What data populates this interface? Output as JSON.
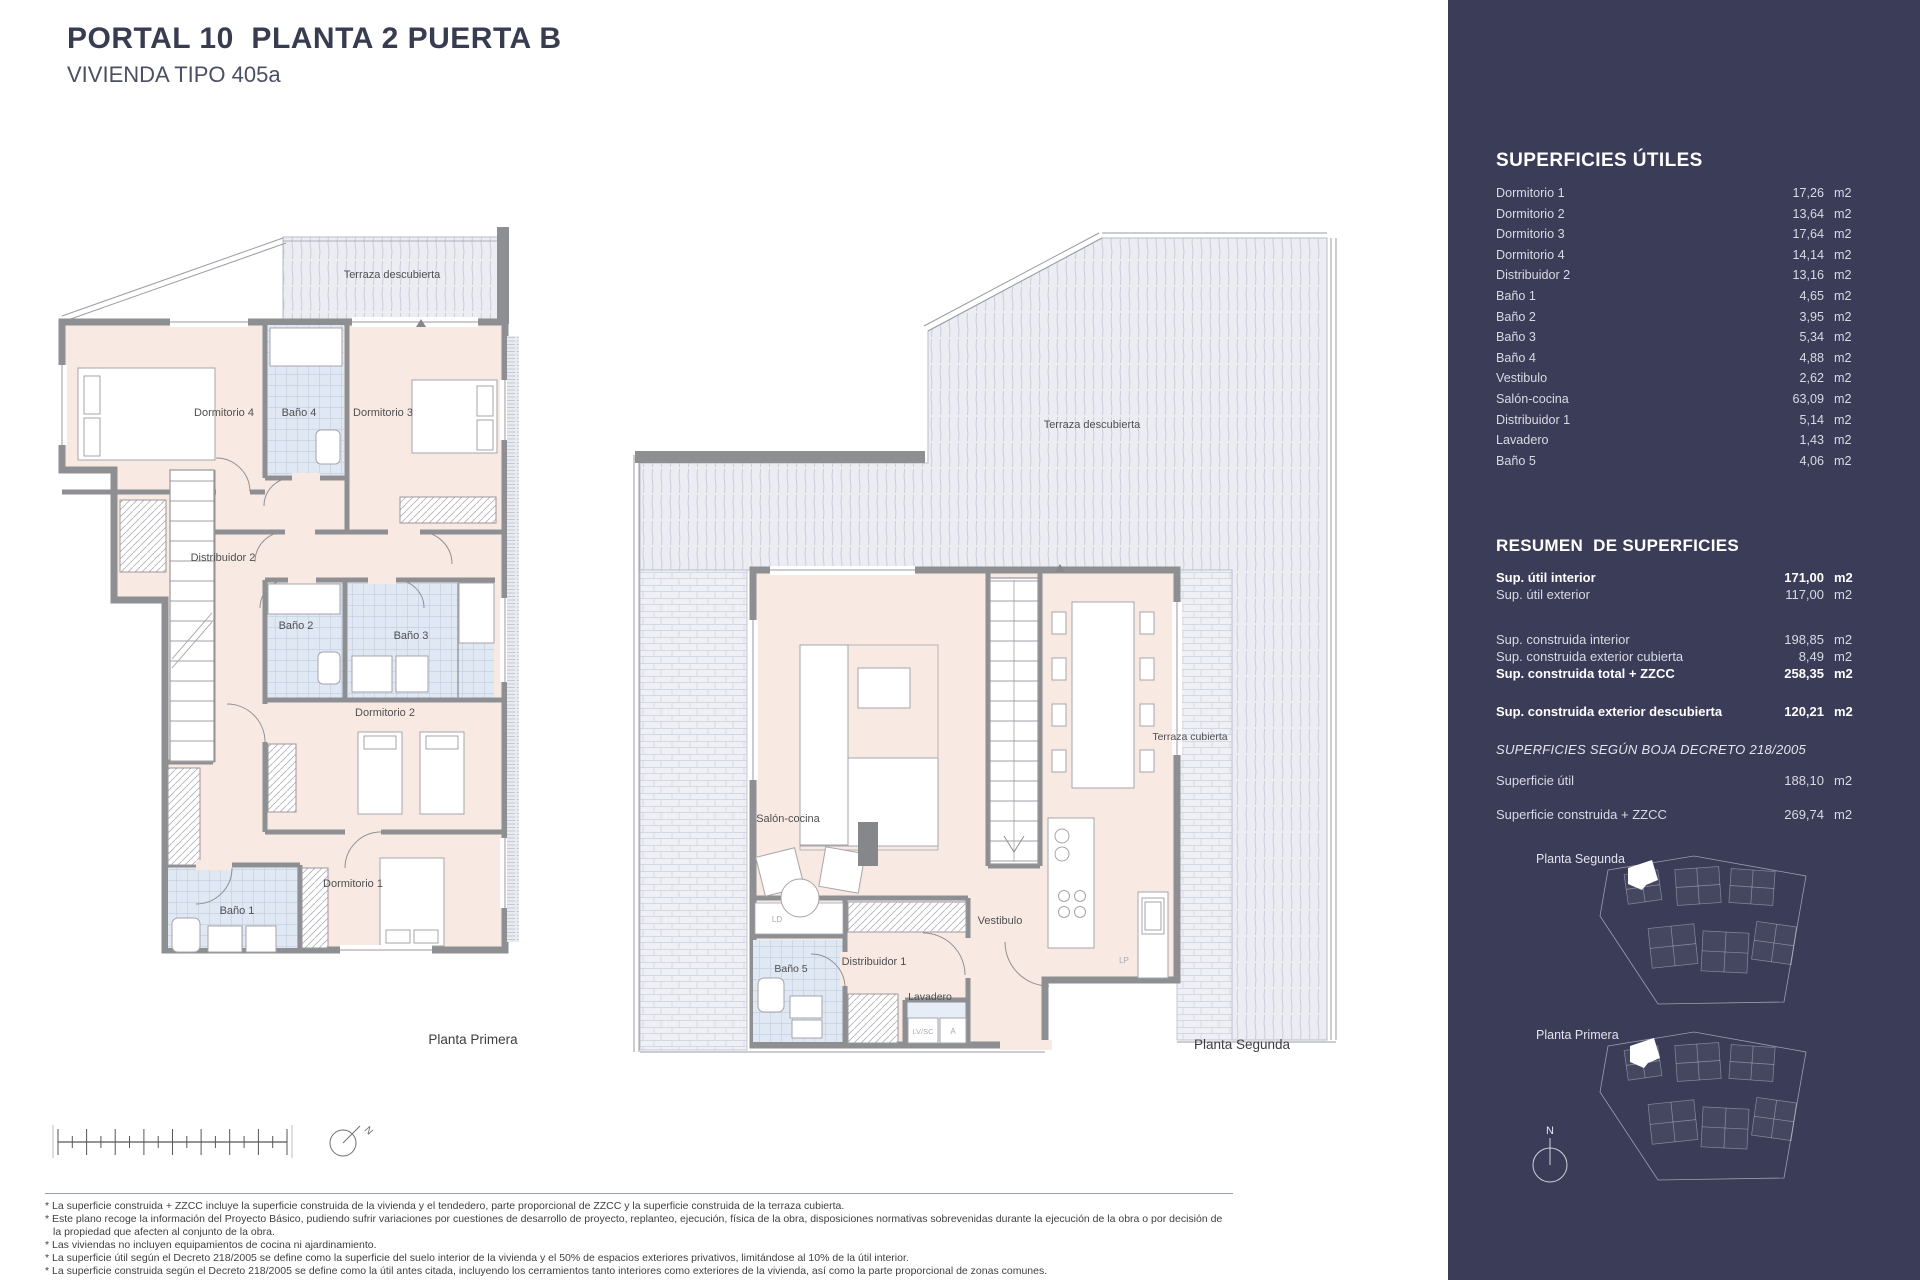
{
  "header": {
    "title": "PORTAL 10  PLANTA 2 PUERTA B",
    "subtitle": "VIVIENDA TIPO 405a"
  },
  "sidebar": {
    "unit": "m2",
    "superficies_utiles": {
      "heading": "SUPERFICIES ÚTILES",
      "rows": [
        {
          "label": "Dormitorio 1",
          "value": "17,26"
        },
        {
          "label": "Dormitorio 2",
          "value": "13,64"
        },
        {
          "label": "Dormitorio 3",
          "value": "17,64"
        },
        {
          "label": "Dormitorio 4",
          "value": "14,14"
        },
        {
          "label": "Distribuidor 2",
          "value": "13,16"
        },
        {
          "label": "Baño 1",
          "value": "4,65"
        },
        {
          "label": "Baño 2",
          "value": "3,95"
        },
        {
          "label": "Baño 3",
          "value": "5,34"
        },
        {
          "label": "Baño 4",
          "value": "4,88"
        },
        {
          "label": "Vestibulo",
          "value": "2,62"
        },
        {
          "label": "Salón-cocina",
          "value": "63,09"
        },
        {
          "label": "Distribuidor 1",
          "value": "5,14"
        },
        {
          "label": "Lavadero",
          "value": "1,43"
        },
        {
          "label": "Baño 5",
          "value": "4,06"
        }
      ]
    },
    "resumen": {
      "heading": "RESUMEN  DE SUPERFICIES",
      "rows": [
        {
          "label": "Sup. útil interior",
          "value": "171,00"
        },
        {
          "label": "Sup. útil exterior",
          "value": "117,00"
        },
        {
          "label": "Sup. construida interior",
          "value": "198,85"
        },
        {
          "label": "Sup. construida exterior cubierta",
          "value": "8,49"
        },
        {
          "label": "Sup. construida total + ZZCC",
          "value": "258,35"
        },
        {
          "label": "Sup. construida exterior descubierta",
          "value": "120,21"
        }
      ]
    },
    "boja": {
      "heading": "SUPERFICIES SEGÚN BOJA DECRETO 218/2005",
      "rows": [
        {
          "label": "Superficie útil",
          "value": "188,10"
        },
        {
          "label": "Superficie construida + ZZCC",
          "value": "269,74"
        }
      ]
    },
    "keyplans": {
      "segunda": "Planta Segunda",
      "primera": "Planta Primera"
    },
    "north_label": "N"
  },
  "plans": {
    "left": {
      "caption": "Planta  Primera",
      "labels": {
        "terraza": "Terraza descubierta",
        "dorm4": "Dormitorio 4",
        "bano4": "Baño 4",
        "dorm3": "Dormitorio 3",
        "distribuidor2": "Distribuidor 2",
        "bano2": "Baño 2",
        "bano3": "Baño 3",
        "dorm2": "Dormitorio 2",
        "bano1": "Baño 1",
        "dorm1": "Dormitorio 1"
      }
    },
    "right": {
      "caption": "Planta  Segunda",
      "labels": {
        "terraza_descubierta": "Terraza descubierta",
        "terraza_cubierta": "Terraza cubierta",
        "salon": "Salón-cocina",
        "vestibulo": "Vestibulo",
        "distribuidor1": "Distribuidor 1",
        "bano5": "Baño 5",
        "lavadero": "Lavadero",
        "ld": "LD",
        "lvsc": "LV/SC",
        "a": "A",
        "lp": "LP"
      }
    }
  },
  "compass": {
    "label": "N"
  },
  "colors": {
    "sidebar": "#3a3c58",
    "room_fill": "#f8eae3",
    "bath_fill": "#e0e8f3",
    "wall": "#8d8f93",
    "hatch_fill": "#ecedf3"
  },
  "footnotes": [
    "* La superficie construida + ZZCC incluye la superficie construida de la vivienda y el tendedero, parte proporcional de ZZCC y la superficie construida de la terraza cubierta.",
    "* Este plano recoge la información del Proyecto Básico, pudiendo sufrir variaciones por cuestiones de desarrollo de proyecto, replanteo, ejecución, física de la obra, disposiciones normativas sobrevenidas durante la ejecución de la obra o por decisión de la propiedad que afecten al conjunto de la obra.",
    "* Las viviendas no incluyen equipamientos de cocina ni ajardinamiento.",
    "* La superficie útil según el Decreto 218/2005 se define como la superficie del suelo interior de la vivienda y el 50% de espacios exteriores privativos, limitándose al 10% de la útil interior.",
    "* La superficie construida según el Decreto 218/2005 se define como la útil antes citada, incluyendo los cerramientos tanto interiores como exteriores de la vivienda, así como la parte proporcional de zonas comunes."
  ]
}
